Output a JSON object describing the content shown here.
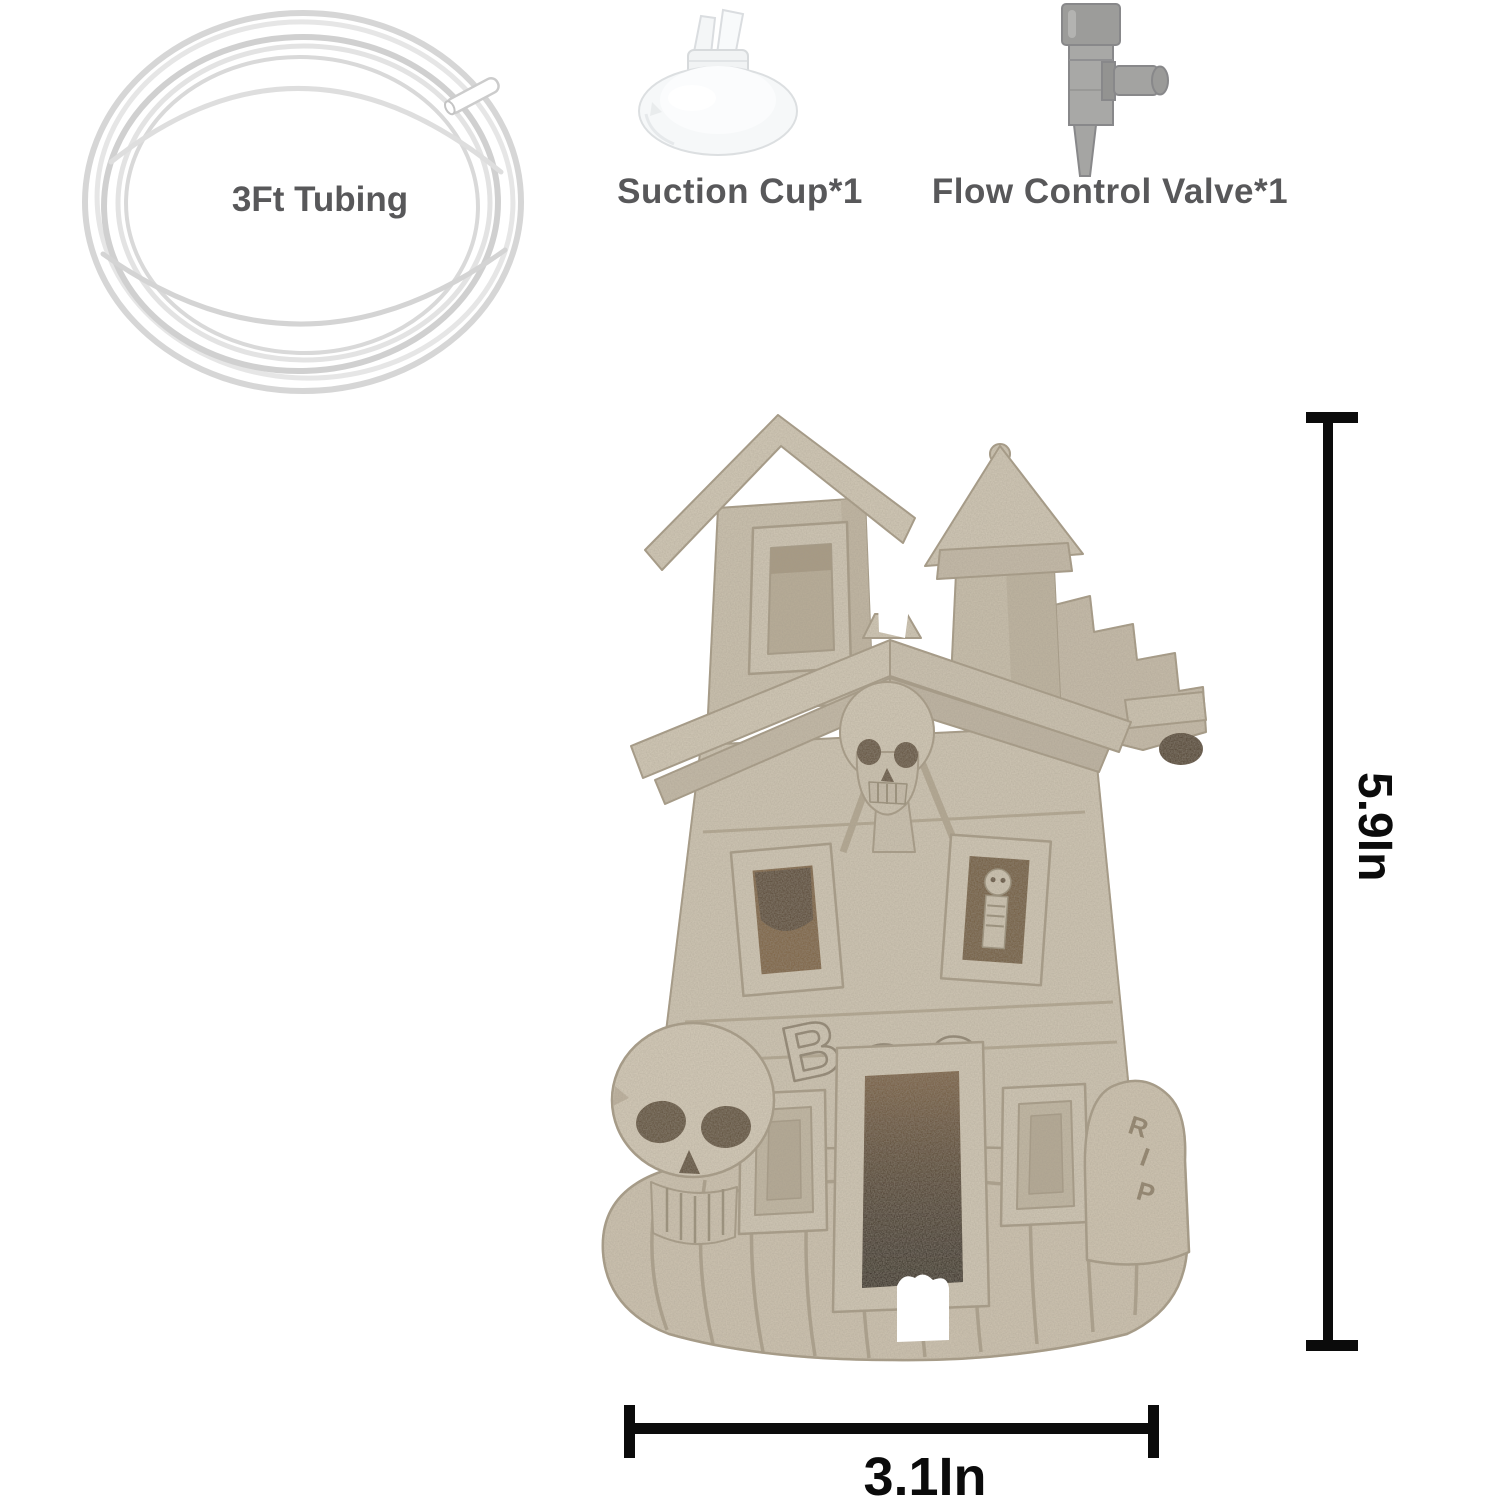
{
  "page": {
    "background": "#ffffff",
    "description": "Aquarium haunted house ornament product image with included accessories and dimensions"
  },
  "accessories": {
    "tubing": {
      "label": "3Ft Tubing"
    },
    "suction_cup": {
      "label": "Suction Cup*1"
    },
    "flow_valve": {
      "label": "Flow Control Valve*1"
    }
  },
  "figurine": {
    "kind": "sandstone haunted house aquarium ornament with skull and tombstone",
    "carvings": {
      "boo": [
        "B",
        "O",
        "O"
      ],
      "rip": [
        "R",
        "I",
        "P"
      ]
    },
    "colors": {
      "sandstone": "#d2c9b7",
      "sandstone_shade": "#c6bcaa",
      "sandstone_dark_line": "#a79c87",
      "window_interior": "#6f5838",
      "door_dark": "#1c140b"
    }
  },
  "dimensions": {
    "height_label": "5.9In",
    "width_label": "3.1In",
    "line_color": "#0b0b0b"
  },
  "label_color": "#58585a"
}
